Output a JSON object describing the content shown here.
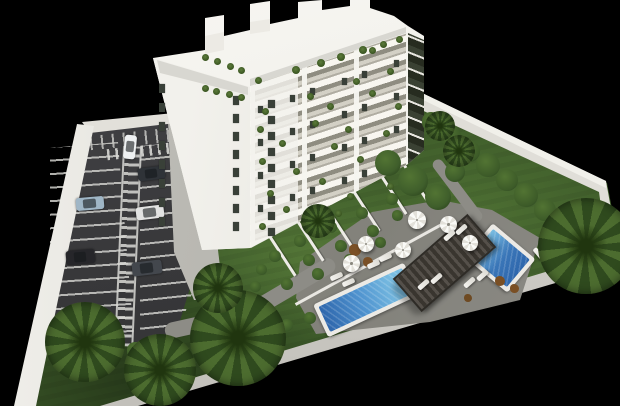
{
  "meta": {
    "alt": "Aerial 3D architectural rendering on a black background: white nine-storey apartment building with rooftop penthouses and planted balconies, striped parking lot with six cars behind a white wall, landscaped garden with palm trees and hedges, stone pool deck with two blue swimming pools, a dark slatted pergola, white parasols and sun loungers, all enclosed by white perimeter walls."
  },
  "counts": {
    "building_floors_visible": 9,
    "pools": 2,
    "cars": 6,
    "parasols": 6,
    "sun_loungers": 12,
    "palm_trees": 8
  },
  "colors": {
    "background": "#000000",
    "grass_base": "#3e5c2a",
    "asphalt": "#38383a",
    "stripe_white": "#cfcfcb",
    "building_white": "#f4f3ee",
    "roof_gray": "#d8d7d1",
    "window_dark": "#394038",
    "deck_gray": "#8e8d88",
    "path_gray": "#8d8c86",
    "pool_coping": "#eceae5",
    "water_deep": "#2e66ac",
    "water_light": "#79bde2",
    "pergola_dark": "#39352f",
    "pergola_slat": "#55504a",
    "palm_green": "#4c6c2f",
    "palm_dark": "#2f4a1e",
    "bush_green": "#3c5a28",
    "bush_light": "#527433",
    "tree_green": "#3f5e2b",
    "umbrella_white": "#fafaf7",
    "lounger_white": "#f4f3ef"
  },
  "objects": {
    "cars": [
      [
        118,
        141,
        24,
        12,
        96,
        "#eef0f1"
      ],
      [
        138,
        167,
        27,
        13,
        -7,
        "#2f3338"
      ],
      [
        76,
        197,
        28,
        13,
        -5,
        "#9fb6c6"
      ],
      [
        136,
        206,
        28,
        13,
        -7,
        "#e2e3e2"
      ],
      [
        66,
        250,
        29,
        14,
        -5,
        "#26262a"
      ],
      [
        132,
        261,
        30,
        14,
        -7,
        "#43474d"
      ]
    ],
    "palms": [
      [
        45,
        302,
        80
      ],
      [
        124,
        334,
        72
      ],
      [
        190,
        290,
        96
      ],
      [
        538,
        198,
        96
      ],
      [
        425,
        111,
        30
      ],
      [
        443,
        135,
        32
      ],
      [
        301,
        204,
        34
      ],
      [
        193,
        263,
        50
      ]
    ],
    "trees": [
      [
        375,
        150,
        26
      ],
      [
        398,
        166,
        30
      ],
      [
        425,
        184,
        26
      ],
      [
        445,
        162,
        20
      ]
    ],
    "bushes": [
      [
        269,
        250,
        12
      ],
      [
        256,
        264,
        11
      ],
      [
        294,
        235,
        12
      ],
      [
        303,
        254,
        12
      ],
      [
        325,
        221,
        12
      ],
      [
        335,
        240,
        12
      ],
      [
        356,
        207,
        12
      ],
      [
        367,
        225,
        12
      ],
      [
        386,
        193,
        12
      ],
      [
        392,
        210,
        11
      ],
      [
        281,
        278,
        12
      ],
      [
        312,
        268,
        12
      ],
      [
        344,
        254,
        12
      ],
      [
        375,
        237,
        11
      ],
      [
        250,
        281,
        11
      ],
      [
        198,
        313,
        14
      ],
      [
        224,
        321,
        13
      ],
      [
        252,
        314,
        13
      ],
      [
        281,
        319,
        12
      ],
      [
        304,
        312,
        12
      ],
      [
        422,
        112,
        20
      ],
      [
        439,
        125,
        22
      ],
      [
        458,
        140,
        22
      ],
      [
        476,
        153,
        24
      ],
      [
        496,
        169,
        22
      ],
      [
        514,
        183,
        24
      ],
      [
        534,
        199,
        22
      ],
      [
        553,
        213,
        22
      ],
      [
        572,
        225,
        20
      ],
      [
        49,
        334,
        18
      ],
      [
        75,
        338,
        18
      ],
      [
        101,
        341,
        18
      ],
      [
        127,
        342,
        18
      ],
      [
        153,
        342,
        16
      ],
      [
        349,
        244,
        12,
        null,
        null,
        "#7a5026"
      ],
      [
        363,
        257,
        10,
        null,
        null,
        "#7a5026"
      ],
      [
        495,
        276,
        10,
        null,
        null,
        "#7a4f24"
      ],
      [
        510,
        284,
        9,
        null,
        null,
        "#7a4f24"
      ],
      [
        464,
        294,
        8,
        null,
        null,
        "#6e4a22"
      ]
    ],
    "umbrellas": [
      [
        408,
        211,
        18
      ],
      [
        440,
        216,
        17
      ],
      [
        395,
        242,
        16
      ],
      [
        358,
        236,
        16
      ],
      [
        343,
        255,
        17
      ],
      [
        462,
        235,
        16
      ]
    ],
    "loungers": [
      [
        330,
        274,
        13,
        5,
        -24
      ],
      [
        342,
        280,
        13,
        5,
        -24
      ],
      [
        367,
        262,
        13,
        5,
        -24
      ],
      [
        379,
        255,
        13,
        5,
        -24
      ],
      [
        417,
        282,
        13,
        5,
        -41
      ],
      [
        430,
        276,
        13,
        5,
        -41
      ],
      [
        463,
        280,
        13,
        5,
        -41
      ],
      [
        476,
        273,
        13,
        5,
        -41
      ],
      [
        443,
        233,
        13,
        5,
        -41
      ],
      [
        455,
        227,
        13,
        5,
        -41
      ],
      [
        532,
        251,
        13,
        5,
        50
      ],
      [
        544,
        244,
        13,
        5,
        50
      ]
    ],
    "terrace_walls": [
      [
        269,
        238,
        3,
        46,
        -33
      ],
      [
        297,
        223,
        3,
        46,
        -33
      ],
      [
        325,
        208,
        3,
        46,
        -33
      ],
      [
        353,
        193,
        3,
        46,
        -33
      ],
      [
        381,
        178,
        3,
        44,
        -33
      ],
      [
        403,
        166,
        3,
        42,
        -33
      ]
    ],
    "plants": [
      [
        307,
        93,
        7
      ],
      [
        353,
        78,
        7
      ],
      [
        387,
        68,
        7
      ],
      [
        262,
        108,
        7
      ],
      [
        327,
        103,
        7
      ],
      [
        369,
        90,
        7
      ],
      [
        257,
        126,
        7
      ],
      [
        312,
        120,
        7
      ],
      [
        395,
        103,
        7
      ],
      [
        279,
        140,
        7
      ],
      [
        345,
        126,
        7
      ],
      [
        259,
        158,
        7
      ],
      [
        331,
        143,
        7
      ],
      [
        383,
        130,
        7
      ],
      [
        293,
        168,
        7
      ],
      [
        357,
        156,
        7
      ],
      [
        267,
        190,
        7
      ],
      [
        319,
        178,
        7
      ],
      [
        393,
        158,
        7
      ],
      [
        283,
        206,
        7
      ],
      [
        347,
        193,
        7
      ],
      [
        259,
        223,
        7
      ],
      [
        335,
        210,
        7
      ],
      [
        387,
        183,
        7
      ],
      [
        202,
        54,
        7
      ],
      [
        214,
        58,
        7
      ],
      [
        227,
        63,
        7
      ],
      [
        238,
        67,
        7
      ],
      [
        202,
        85,
        7
      ],
      [
        213,
        88,
        7
      ],
      [
        226,
        91,
        7
      ],
      [
        238,
        94,
        7
      ],
      [
        255,
        77,
        7
      ],
      [
        292,
        66,
        8
      ],
      [
        317,
        59,
        8
      ],
      [
        337,
        53,
        8
      ],
      [
        359,
        46,
        8
      ],
      [
        380,
        41,
        7
      ],
      [
        396,
        36,
        7
      ],
      [
        369,
        47,
        7
      ]
    ],
    "side_windows": [
      [
        159,
        84,
        6,
        9
      ],
      [
        159,
        103,
        6,
        9
      ],
      [
        159,
        122,
        6,
        9
      ],
      [
        159,
        141,
        6,
        9
      ],
      [
        159,
        160,
        6,
        9
      ],
      [
        159,
        179,
        6,
        9
      ],
      [
        159,
        198,
        6,
        9
      ],
      [
        159,
        217,
        6,
        9
      ],
      [
        233,
        96,
        6,
        9
      ],
      [
        233,
        114,
        6,
        9
      ],
      [
        233,
        132,
        6,
        9
      ],
      [
        233,
        150,
        6,
        9
      ],
      [
        233,
        168,
        6,
        9
      ],
      [
        233,
        186,
        6,
        9
      ],
      [
        233,
        204,
        6,
        9
      ],
      [
        233,
        222,
        6,
        9
      ],
      [
        268,
        100,
        7,
        8
      ],
      [
        268,
        116,
        7,
        8
      ],
      [
        268,
        132,
        7,
        8
      ],
      [
        268,
        148,
        7,
        8
      ],
      [
        268,
        164,
        7,
        8
      ],
      [
        268,
        180,
        7,
        8
      ],
      [
        268,
        196,
        7,
        8
      ],
      [
        268,
        212,
        7,
        8
      ],
      [
        268,
        228,
        7,
        8
      ],
      [
        258,
        106,
        5,
        7
      ],
      [
        258,
        139,
        5,
        7
      ],
      [
        258,
        172,
        5,
        7
      ],
      [
        258,
        205,
        5,
        7
      ],
      [
        290,
        95,
        5,
        7
      ],
      [
        290,
        128,
        5,
        7
      ],
      [
        290,
        161,
        5,
        7
      ],
      [
        290,
        194,
        5,
        7
      ],
      [
        310,
        88,
        5,
        7
      ],
      [
        310,
        121,
        5,
        7
      ],
      [
        310,
        154,
        5,
        7
      ],
      [
        310,
        187,
        5,
        7
      ],
      [
        342,
        78,
        5,
        7
      ],
      [
        342,
        111,
        5,
        7
      ],
      [
        342,
        144,
        5,
        7
      ],
      [
        342,
        177,
        5,
        7
      ],
      [
        362,
        71,
        5,
        7
      ],
      [
        362,
        104,
        5,
        7
      ],
      [
        362,
        137,
        5,
        7
      ],
      [
        362,
        170,
        5,
        7
      ],
      [
        394,
        60,
        5,
        7
      ],
      [
        394,
        93,
        5,
        7
      ],
      [
        394,
        126,
        5,
        7
      ],
      [
        394,
        159,
        5,
        7
      ]
    ]
  }
}
